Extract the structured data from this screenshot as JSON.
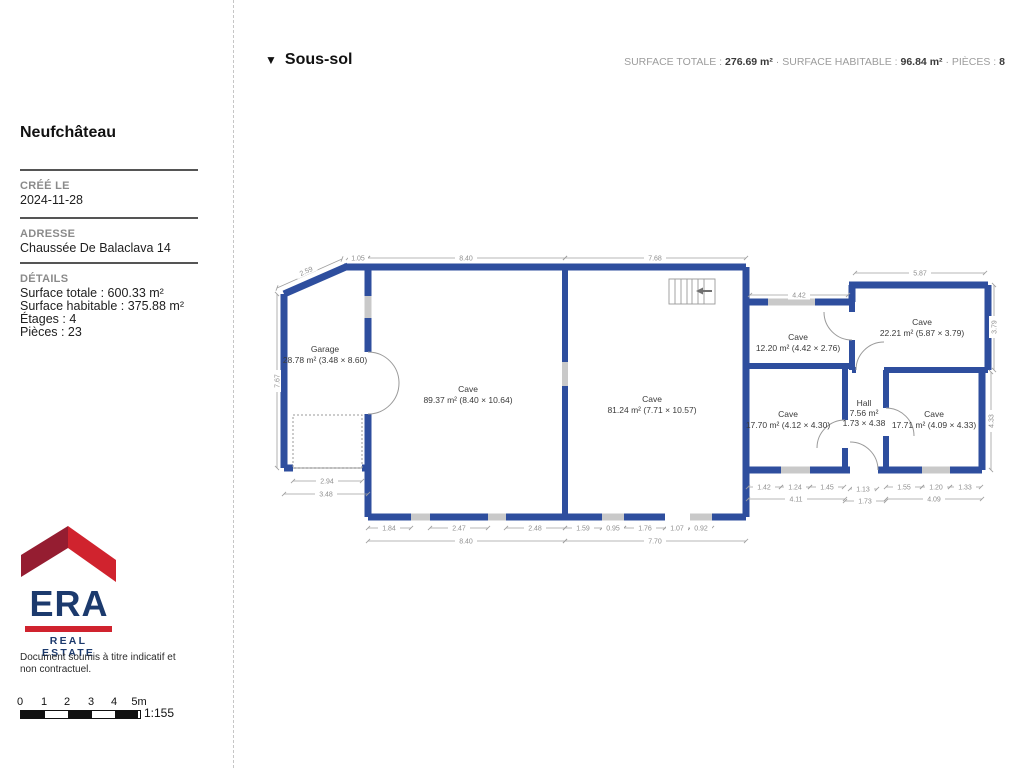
{
  "header": {
    "floor_label": "Sous-sol",
    "stats": [
      {
        "label": "SURFACE TOTALE :",
        "value": "276.69 m²"
      },
      {
        "label": "SURFACE HABITABLE :",
        "value": "96.84 m²"
      },
      {
        "label": "PIÈCES :",
        "value": "8"
      }
    ]
  },
  "sidebar": {
    "title": "Neufchâteau",
    "created_label": "CRÉÉ LE",
    "created_value": "2024-11-28",
    "address_label": "ADRESSE",
    "address_value": "Chaussée De Balaclava 14",
    "details_label": "DÉTAILS",
    "details": [
      "Surface totale : 600.33 m²",
      "Surface habitable : 375.88 m²",
      "Étages : 4",
      "Pièces : 23"
    ],
    "logo": {
      "brand": "ERA",
      "tagline": "REAL ESTATE"
    },
    "disclaimer": "Document soumis à titre indicatif et non contractuel.",
    "scale": {
      "ticks": [
        "0",
        "1",
        "2",
        "3",
        "4",
        "5m"
      ],
      "ratio": "1:155"
    }
  },
  "colors": {
    "wall": "#2e4e9e",
    "window": "#c9c9c9",
    "logo_red": "#d0232e",
    "logo_dark_red": "#951d31",
    "logo_navy": "#1c3a6d"
  },
  "plan": {
    "rooms": [
      {
        "name": "Garage",
        "area": "28.78 m² (3.48 × 8.60)"
      },
      {
        "name": "Cave",
        "area": "89.37 m² (8.40 × 10.64)"
      },
      {
        "name": "Cave",
        "area": "81.24 m² (7.71 × 10.57)"
      },
      {
        "name": "Cave",
        "area": "12.20 m² (4.42 × 2.76)"
      },
      {
        "name": "Cave",
        "area": "22.21 m² (5.87 × 3.79)"
      },
      {
        "name": "Cave",
        "area": "17.70 m² (4.12 × 4.30)"
      },
      {
        "name": "Hall",
        "area": "7.56 m²",
        "size": "1.73 × 4.38"
      },
      {
        "name": "Cave",
        "area": "17.71 m² (4.09 × 4.33)"
      }
    ],
    "dims": [
      "2.59",
      "1.05",
      "8.40",
      "7.68",
      "4.42",
      "5.87",
      "7.67",
      "3.79",
      "4.33",
      "2.94",
      "3.48",
      "1.84",
      "2.47",
      "2.48",
      "8.40",
      "1.59",
      "0.95",
      "1.76",
      "1.07",
      "0.92",
      "7.70",
      "1.42",
      "1.24",
      "1.45",
      "4.11",
      "1.13",
      "1.73",
      "1.55",
      "1.20",
      "1.33",
      "4.09"
    ]
  }
}
